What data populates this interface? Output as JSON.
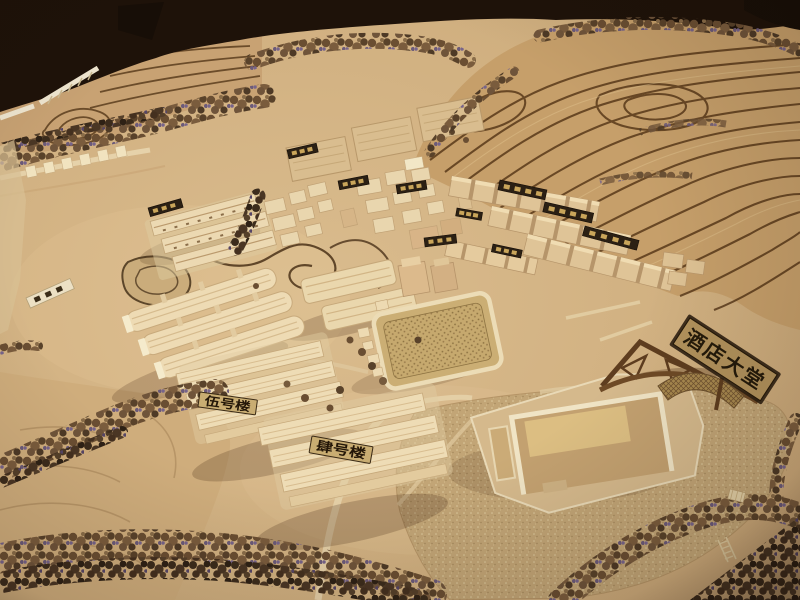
{
  "scene": {
    "type": "photo-of-architectural-scale-model",
    "description": "Wooden architectural scale model of a hillside hotel resort village with terraced hills, tree bands, building clusters and a lake, photographed under warm indoor light",
    "labels": {
      "hotel_lobby_sign": "酒店大堂",
      "building_no5_sign": "伍号楼",
      "building_no4_sign": "肆号楼"
    },
    "colors": {
      "table_background": "#1e1209",
      "terrain_base": "#d3b486",
      "terraced_hill": "#c69f6a",
      "contour_line": "#523315",
      "building_cream": "#ecd9b2",
      "placard_dark": "#2b2014",
      "placard_gold": "#c9a55a",
      "signboard_tan": "#b2925c",
      "sign_text_dark": "#241a0a",
      "foliage_brown": "#6a4e32",
      "foliage_violet": "#6b5a78",
      "water_tan": "#c2a576"
    }
  }
}
